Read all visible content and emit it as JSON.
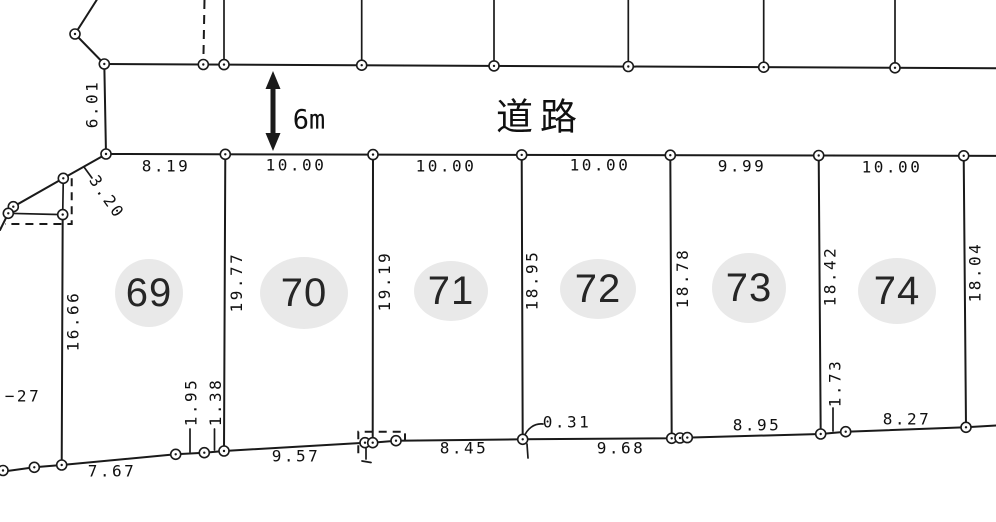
{
  "road": {
    "label": "道路",
    "width_label": "6m"
  },
  "plots": [
    {
      "number": "69"
    },
    {
      "number": "70"
    },
    {
      "number": "71"
    },
    {
      "number": "72"
    },
    {
      "number": "73"
    },
    {
      "number": "74"
    }
  ],
  "dimensions": {
    "top_widths": [
      "8.19",
      "10.00",
      "10.00",
      "10.00",
      "9.99",
      "10.00"
    ],
    "depths": [
      "19.77",
      "19.19",
      "18.95",
      "18.78",
      "18.42",
      "18.04"
    ],
    "bottom_lengths": [
      "7.67",
      "9.57",
      "8.45",
      "9.68",
      "8.95",
      "8.27"
    ],
    "small_offsets": [
      "1.95",
      "1.38",
      "0.31",
      "1.73"
    ],
    "west_upper": "6.01",
    "west_diagonal": "3.20",
    "west_side": "16.66",
    "edge_label": "−27"
  }
}
